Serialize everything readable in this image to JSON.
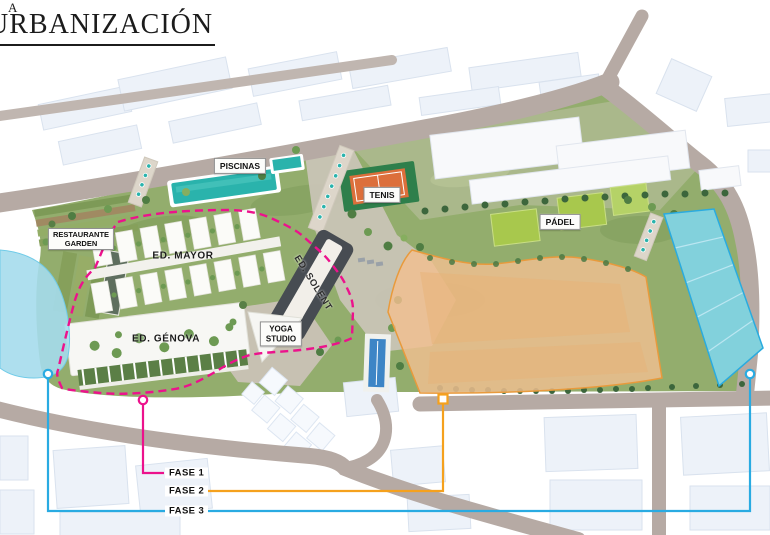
{
  "header": {
    "overline": "A",
    "title": "URBANIZACIÓN"
  },
  "map": {
    "area_labels": {
      "piscinas": "PISCINAS",
      "tenis": "TENIS",
      "padel": "PÁDEL",
      "restaurante_line1": "RESTAURANTE",
      "restaurante_line2": "GARDEN",
      "yoga_line1": "YOGA",
      "yoga_line2": "STUDIO",
      "ed_mayor": "ED. MAYOR",
      "ed_genova": "ED. GÉNOVA",
      "ed_solent": "ED. SOLENT"
    },
    "phases": [
      {
        "label": "FASE 1",
        "color": "#ec128c"
      },
      {
        "label": "FASE 2",
        "color": "#f5a11d"
      },
      {
        "label": "FASE 3",
        "color": "#29abe2"
      }
    ],
    "colors": {
      "phase1": "#ec128c",
      "phase2": "#f5a11d",
      "phase3": "#29abe2",
      "phase2_fill": "#f2bf90",
      "phase2_border": "#e89a3c",
      "phase3_fill": "#a5dcec",
      "road": "#b6aaa4",
      "park": "#93ad6d",
      "pool": "#2ab3ac",
      "tennis_court": "#dc6f3b",
      "court_green": "#2e7f4b",
      "padel_green": "#a8c84d"
    }
  }
}
